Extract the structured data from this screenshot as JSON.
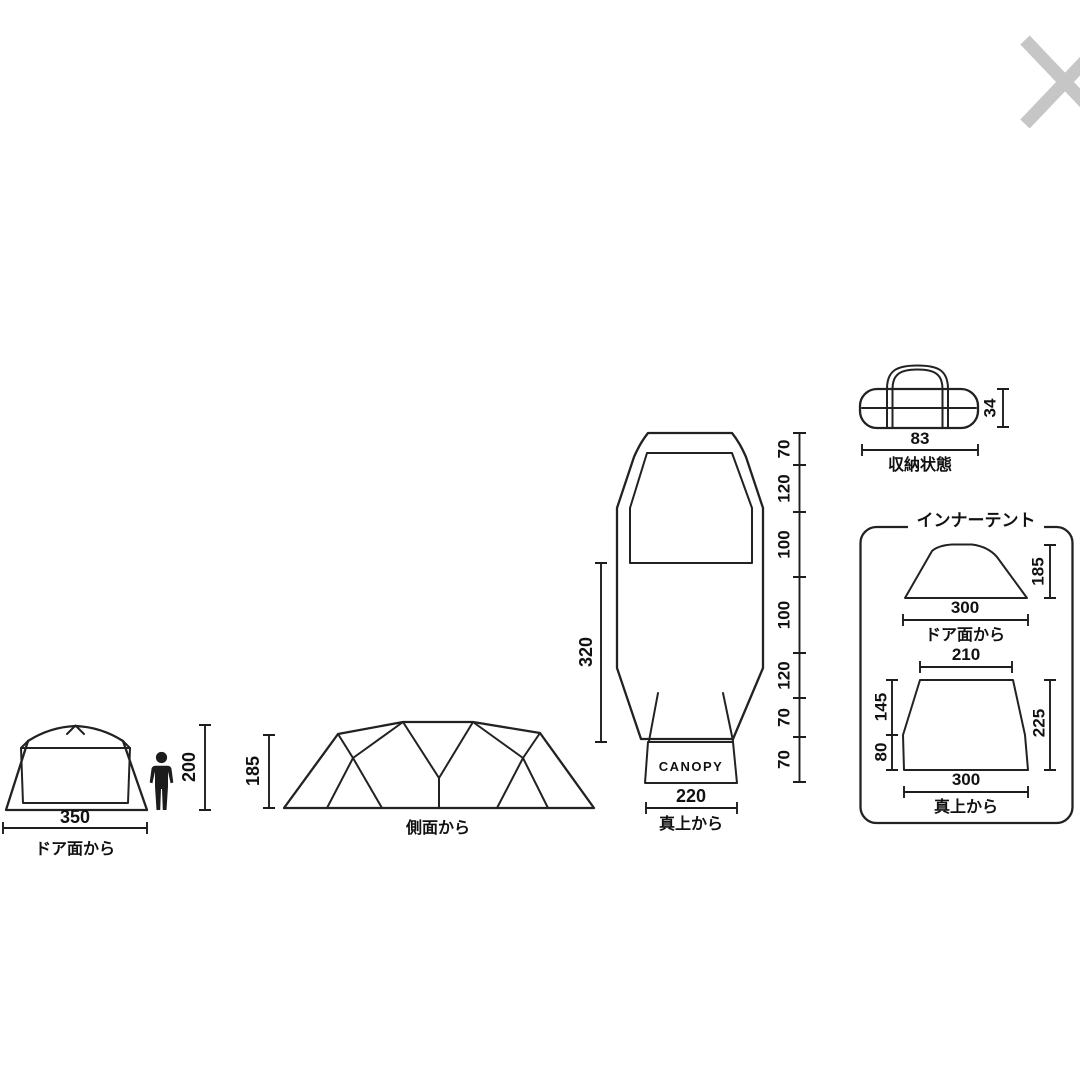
{
  "colors": {
    "background": "#ffffff",
    "line": "#222222",
    "text": "#111111",
    "close_icon": "#c6c6c6"
  },
  "front_view": {
    "width": "350",
    "caption": "ドア面から",
    "person_height": "200"
  },
  "side_view": {
    "height": "185",
    "caption": "側面から"
  },
  "top_view": {
    "inner_length": "320",
    "canopy_width": "220",
    "caption": "真上から",
    "canopy_label": "CANOPY",
    "segments": [
      "70",
      "120",
      "100",
      "100",
      "120",
      "70",
      "70"
    ]
  },
  "storage": {
    "width": "83",
    "height": "34",
    "caption": "収納状態"
  },
  "inner_tent": {
    "title": "インナーテント",
    "front": {
      "width": "300",
      "height": "185",
      "caption": "ドア面から"
    },
    "top": {
      "top_width": "210",
      "bottom_width": "300",
      "upper_left": "145",
      "lower_left": "80",
      "right": "225",
      "caption": "真上から"
    }
  }
}
